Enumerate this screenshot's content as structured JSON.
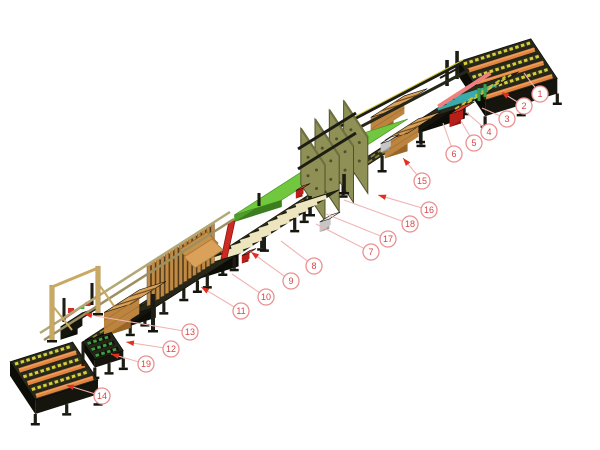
{
  "diagram": {
    "kind": "isometric-machine-line-illustration",
    "subject": "pallet assembly line with numbered component callouts",
    "background": "#ffffff"
  },
  "palette": {
    "callout_circle_stroke": "#ea9090",
    "callout_number": "#d64545",
    "leader_line": "#f2b3b3",
    "arrow_red": "#e03020",
    "frame_dark": "#24241b",
    "frame_side": "#15150e",
    "roller_orange": "#e08440",
    "chain_yellow": "#d6cf3a",
    "slat_cream": "#ece5bd",
    "wood_tan": "#d9a159",
    "plate_olive": "#8f9055",
    "table_green": "#71c83e",
    "conveyor_green": "#3f9f3f",
    "machine_red": "#cc2a22",
    "rail_salmon": "#ef8080",
    "chain_teal": "#3aabab",
    "rail_steel": "#b3a875"
  },
  "callouts": [
    {
      "label": "1",
      "cx": 540,
      "cy": 94,
      "tx": 524,
      "ty": 73,
      "arrow": false
    },
    {
      "label": "2",
      "cx": 524,
      "cy": 106,
      "tx": 501,
      "ty": 92,
      "arrow": true
    },
    {
      "label": "3",
      "cx": 507,
      "cy": 119,
      "tx": 482,
      "ty": 108,
      "arrow": false
    },
    {
      "label": "4",
      "cx": 489,
      "cy": 132,
      "tx": 466,
      "ty": 112,
      "arrow": false
    },
    {
      "label": "5",
      "cx": 474,
      "cy": 143,
      "tx": 461,
      "ty": 121,
      "arrow": false
    },
    {
      "label": "6",
      "cx": 454,
      "cy": 154,
      "tx": 443,
      "ty": 123,
      "arrow": false
    },
    {
      "label": "7",
      "cx": 371,
      "cy": 252,
      "tx": 316,
      "ty": 224,
      "arrow": false
    },
    {
      "label": "8",
      "cx": 314,
      "cy": 266,
      "tx": 281,
      "ty": 241,
      "arrow": false
    },
    {
      "label": "9",
      "cx": 291,
      "cy": 281,
      "tx": 251,
      "ty": 252,
      "arrow": true
    },
    {
      "label": "10",
      "cx": 266,
      "cy": 297,
      "tx": 232,
      "ty": 274,
      "arrow": false
    },
    {
      "label": "11",
      "cx": 241,
      "cy": 311,
      "tx": 201,
      "ty": 287,
      "arrow": true
    },
    {
      "label": "12",
      "cx": 171,
      "cy": 349,
      "tx": 126,
      "ty": 342,
      "arrow": true
    },
    {
      "label": "13",
      "cx": 190,
      "cy": 332,
      "tx": 84,
      "ty": 314,
      "arrow": true
    },
    {
      "label": "14",
      "cx": 102,
      "cy": 396,
      "tx": 66,
      "ty": 385,
      "arrow": true
    },
    {
      "label": "15",
      "cx": 422,
      "cy": 181,
      "tx": 403,
      "ty": 158,
      "arrow": true
    },
    {
      "label": "16",
      "cx": 429,
      "cy": 210,
      "tx": 378,
      "ty": 195,
      "arrow": true
    },
    {
      "label": "17",
      "cx": 388,
      "cy": 239,
      "tx": 326,
      "ty": 214,
      "arrow": false
    },
    {
      "label": "18",
      "cx": 410,
      "cy": 224,
      "tx": 344,
      "ty": 200,
      "arrow": false
    },
    {
      "label": "19",
      "cx": 146,
      "cy": 364,
      "tx": 111,
      "ty": 354,
      "arrow": true
    }
  ],
  "scene": [
    {
      "t": "band",
      "name": "main-conveyor-line",
      "a": [
        452,
        106
      ],
      "b": [
        98,
        336
      ],
      "hw": 14,
      "top": "#2a2a1f",
      "side": "#15150e",
      "chain": "#8a8530",
      "legs": [
        0.05,
        0.16,
        0.27,
        0.38,
        0.5,
        0.61,
        0.72,
        0.83,
        0.94
      ]
    },
    {
      "t": "mast",
      "name": "infeed-frame-mast",
      "p": [
        447,
        86
      ],
      "w": 3.5,
      "h": 26,
      "fill": "#1d1d15"
    },
    {
      "t": "mast",
      "name": "infeed-frame-mast",
      "p": [
        457,
        79
      ],
      "w": 3.5,
      "h": 28,
      "fill": "#1d1d15"
    },
    {
      "t": "beam",
      "name": "infeed-frame-crossbar",
      "p1": [
        440,
        78
      ],
      "p2": [
        466,
        64
      ],
      "w": 2,
      "fill": "#1d1d15"
    },
    {
      "t": "endconv",
      "name": "infeed-roller-conveyor",
      "c": [
        508,
        70
      ],
      "a": 38,
      "b": 24,
      "d": 15,
      "rows": 6,
      "top": "#262619",
      "roller": "#e08440",
      "chain": "#d6cf3a"
    },
    {
      "t": "box",
      "name": "pallet-transfer-station",
      "c": [
        467,
        97
      ],
      "len": 64,
      "wid": 52,
      "h": 12,
      "top": "#2a2a1e",
      "side": "#15150e",
      "end": "#0d0d08",
      "legs": [
        -26,
        26
      ],
      "legH": 10
    },
    {
      "t": "lines",
      "name": "teal-chain-strips",
      "c": [
        467,
        97
      ],
      "axis": "WV",
      "len": 44,
      "offsets": [
        -10,
        0,
        10
      ],
      "offAxis": "LR",
      "stroke": "#3aabab",
      "w": 3
    },
    {
      "t": "lines",
      "name": "yellow-chain-strips",
      "c": [
        467,
        97
      ],
      "axis": "LR",
      "len": 60,
      "offsets": [
        14,
        20
      ],
      "offAxis": "WV",
      "stroke": "#c6bf36",
      "w": 2,
      "dash": "5 3"
    },
    {
      "t": "lines",
      "name": "pink-guide-rail",
      "c": [
        470,
        88
      ],
      "axis": "LR",
      "len": 62,
      "offsets": [
        -6
      ],
      "offAxis": "WV",
      "stroke": "#ef8080",
      "w": 4
    },
    {
      "t": "box",
      "name": "red-centering-unit",
      "c": [
        462,
        108
      ],
      "len": 16,
      "wid": 12,
      "h": 13,
      "top": "#e04434",
      "side": "#b81f18",
      "end": "#8f1812"
    },
    {
      "t": "mast",
      "name": "green-guide-post",
      "p": [
        479,
        101
      ],
      "w": 3,
      "h": 13,
      "fill": "#3aa048"
    },
    {
      "t": "mast",
      "name": "green-guide-post",
      "p": [
        485,
        97
      ],
      "w": 3,
      "h": 13,
      "fill": "#3aa048"
    },
    {
      "t": "box",
      "name": "board-stack",
      "c": [
        399,
        103
      ],
      "len": 40,
      "wid": 24,
      "h": 18,
      "top": "#d9a159",
      "side": "#bd8440",
      "end": "#9a6628",
      "boards": true
    },
    {
      "t": "box",
      "name": "board-stack",
      "c": [
        413,
        126
      ],
      "len": 40,
      "wid": 24,
      "h": 18,
      "top": "#d9a159",
      "side": "#bd8440",
      "end": "#9a6628",
      "boards": true
    },
    {
      "t": "beam",
      "name": "press-feed-rail",
      "p1": [
        337,
        128
      ],
      "p2": [
        463,
        62
      ],
      "w": 3,
      "fill": "#1d1d15",
      "stripe": "#cfc838"
    },
    {
      "t": "beam",
      "name": "press-feed-rail",
      "p1": [
        343,
        136
      ],
      "p2": [
        469,
        70
      ],
      "w": 3,
      "fill": "#26261a"
    },
    {
      "t": "box",
      "name": "assembly-table",
      "c": [
        321,
        167
      ],
      "len": 150,
      "wid": 50,
      "h": 7,
      "top": "#71c83e",
      "side": "#4f9e2a",
      "end": "#3c7e1e",
      "stroke": "#3e8c20"
    },
    {
      "t": "mast",
      "name": "table-leg",
      "p": [
        335,
        158
      ],
      "w": 3,
      "h": 13,
      "fill": "#1d1d15"
    },
    {
      "t": "mast",
      "name": "table-leg",
      "p": [
        259,
        206
      ],
      "w": 3,
      "h": 13,
      "fill": "#1d1d15"
    },
    {
      "t": "box",
      "name": "table-motor",
      "c": [
        390,
        139
      ],
      "len": 12,
      "wid": 9,
      "h": 9,
      "top": "#e8e8e8",
      "side": "#c6c6c6",
      "end": "#9e9e9e"
    },
    {
      "t": "plates",
      "name": "press-frame-plates",
      "c": [
        327,
        177
      ],
      "offs": [
        25,
        8,
        -9,
        -26
      ],
      "e0": -8,
      "e1": 36,
      "h": 56,
      "fill": "#8f9055",
      "stroke": "#50502d"
    },
    {
      "t": "beam",
      "name": "press-crossbeam",
      "p1": [
        298,
        149
      ],
      "p2": [
        356,
        113
      ],
      "w": 3,
      "fill": "#1d1d15"
    },
    {
      "t": "beam",
      "name": "press-crossbeam",
      "p1": [
        298,
        169
      ],
      "p2": [
        356,
        133
      ],
      "w": 3,
      "fill": "#1d1d15"
    },
    {
      "t": "mast",
      "name": "press-leg",
      "p": [
        310,
        214
      ],
      "w": 3.5,
      "h": 18,
      "fill": "#1d1d15",
      "foot": true
    },
    {
      "t": "mast",
      "name": "press-leg",
      "p": [
        344,
        192
      ],
      "w": 3.5,
      "h": 18,
      "fill": "#1d1d15",
      "foot": true
    },
    {
      "t": "box",
      "name": "gray-pusher-unit",
      "c": [
        330,
        217
      ],
      "len": 13,
      "wid": 10,
      "h": 10,
      "top": "#e8e8e8",
      "side": "#c6c6c6",
      "end": "#9e9e9e"
    },
    {
      "t": "box",
      "name": "slat-feeder-station",
      "c": [
        270,
        228
      ],
      "len": 120,
      "wid": 40,
      "h": 12,
      "top": "#262619",
      "side": "#15150e",
      "end": "#0d0d08",
      "legs": [
        -52,
        -20,
        16,
        52
      ],
      "legH": 12,
      "slats": {
        "offs": [
          -50,
          -39,
          -28,
          -17,
          -6,
          5,
          16,
          27,
          38,
          49
        ],
        "stroke": "#ece5bd",
        "w": 4.2
      }
    },
    {
      "t": "quad",
      "name": "red-lift-mast",
      "pts": [
        [
          221,
          259
        ],
        [
          227,
          258
        ],
        [
          235,
          221
        ],
        [
          229,
          221
        ]
      ],
      "fill": "#cc2a22",
      "stroke": "#8f1812"
    },
    {
      "t": "box",
      "name": "red-stop-unit",
      "c": [
        249,
        252
      ],
      "len": 9,
      "wid": 7,
      "h": 8,
      "top": "#e04434",
      "side": "#b81f18",
      "end": "#8f1812"
    },
    {
      "t": "box",
      "name": "red-stop-unit",
      "c": [
        303,
        187
      ],
      "len": 9,
      "wid": 7,
      "h": 8,
      "top": "#e04434",
      "side": "#b81f18",
      "end": "#8f1812"
    },
    {
      "t": "box",
      "name": "magazine-base",
      "c": [
        180,
        286
      ],
      "len": 96,
      "wid": 34,
      "h": 11,
      "top": "#262619",
      "side": "#15150e",
      "end": "#0d0d08",
      "legs": [
        -40,
        0,
        40
      ],
      "legH": 10
    },
    {
      "t": "quad",
      "name": "magazine-backdrop",
      "pts": [
        [
          147,
          306
        ],
        [
          213,
          263
        ],
        [
          213,
          225
        ],
        [
          147,
          268
        ]
      ],
      "fill": "#43361d"
    },
    {
      "t": "fins",
      "name": "board-magazine-fins",
      "p1": [
        147,
        306
      ],
      "p2": [
        211,
        264
      ],
      "n": 15,
      "fw": 3.4,
      "fh": 41,
      "fill": "#c08a45",
      "stroke": "#6e4c20"
    },
    {
      "t": "quad",
      "name": "leaning-board",
      "pts": [
        [
          179,
          250
        ],
        [
          207,
          232
        ],
        [
          218,
          243
        ],
        [
          190,
          261
        ]
      ],
      "fill": "#c89048",
      "stroke": "#96672a"
    },
    {
      "t": "quad",
      "name": "leaning-board",
      "pts": [
        [
          184,
          257
        ],
        [
          212,
          239
        ],
        [
          223,
          250
        ],
        [
          195,
          268
        ]
      ],
      "fill": "#d9a159",
      "stroke": "#a87838"
    },
    {
      "t": "box",
      "name": "board-stack",
      "c": [
        135,
        297
      ],
      "len": 42,
      "wid": 28,
      "h": 24,
      "top": "#d9a159",
      "side": "#bd8440",
      "end": "#9a6628",
      "boards": true
    },
    {
      "t": "mast",
      "name": "frame-post",
      "p": [
        153,
        330
      ],
      "w": 4,
      "h": 36,
      "fill": "#1d1d15",
      "foot": true
    },
    {
      "t": "box",
      "name": "pallet-turner-frame",
      "c": [
        80,
        317
      ],
      "len": 26,
      "wid": 18,
      "h": 13,
      "top": "#262619",
      "side": "#15150e",
      "end": "#0d0d08"
    },
    {
      "t": "beam",
      "name": "red-cross-rail",
      "p1": [
        62,
        320
      ],
      "p2": [
        96,
        297
      ],
      "w": 2,
      "fill": "#c03028"
    },
    {
      "t": "mast",
      "name": "red-clamp",
      "p": [
        71,
        313
      ],
      "w": 6,
      "h": 5,
      "fill": "#d03030"
    },
    {
      "t": "mast",
      "name": "red-clamp",
      "p": [
        88,
        306
      ],
      "w": 5,
      "h": 4,
      "fill": "#d03030"
    },
    {
      "t": "mast",
      "name": "green-sensor",
      "p": [
        82,
        309
      ],
      "w": 4.5,
      "h": 3,
      "fill": "#30c030"
    },
    {
      "t": "mast",
      "name": "frame-mast",
      "p": [
        64,
        322
      ],
      "w": 3,
      "h": 24,
      "fill": "#1d1d15"
    },
    {
      "t": "mast",
      "name": "frame-mast",
      "p": [
        92,
        305
      ],
      "w": 3,
      "h": 22,
      "fill": "#1d1d15"
    },
    {
      "t": "endconv",
      "name": "exit-chain-conveyor",
      "c": [
        103,
        346
      ],
      "a": 15,
      "b": 11,
      "d": 8,
      "rows": 3,
      "top": "#24241b",
      "chain": "#3f9f3f",
      "allChain": true
    },
    {
      "t": "endconv",
      "name": "outfeed-roller-conveyor",
      "c": [
        54,
        371
      ],
      "a": 33,
      "b": 23,
      "d": 14,
      "rows": 6,
      "top": "#262619",
      "roller": "#e08440",
      "chain": "#d6cf3a"
    },
    {
      "t": "mast",
      "name": "outfeed-mast",
      "p": [
        83,
        366
      ],
      "w": 3,
      "h": 24,
      "fill": "#1d1d15"
    },
    {
      "t": "beam",
      "name": "pusher-rail",
      "p1": [
        40,
        333
      ],
      "p2": [
        230,
        212
      ],
      "w": 2.5,
      "fill": "#b3a875"
    },
    {
      "t": "beam",
      "name": "pusher-rail",
      "p1": [
        44,
        340
      ],
      "p2": [
        234,
        219
      ],
      "w": 2.5,
      "fill": "#9c9060"
    },
    {
      "t": "mast",
      "name": "hoist-post",
      "p": [
        52,
        340
      ],
      "w": 5,
      "h": 55,
      "fill": "#c8a862",
      "foot": true
    },
    {
      "t": "mast",
      "name": "hoist-post",
      "p": [
        98,
        313
      ],
      "w": 5,
      "h": 47,
      "fill": "#c8a862",
      "foot": true
    },
    {
      "t": "beam",
      "name": "hoist-crossbar",
      "p1": [
        52,
        287
      ],
      "p2": [
        98,
        268
      ],
      "w": 3,
      "fill": "#c8a862"
    },
    {
      "t": "beam",
      "name": "hoist-brace",
      "p1": [
        52,
        305
      ],
      "p2": [
        72,
        330
      ],
      "w": 2,
      "fill": "#c8a862"
    },
    {
      "t": "beam",
      "name": "hoist-brace",
      "p1": [
        98,
        283
      ],
      "p2": [
        114,
        306
      ],
      "w": 2,
      "fill": "#c8a862"
    }
  ]
}
